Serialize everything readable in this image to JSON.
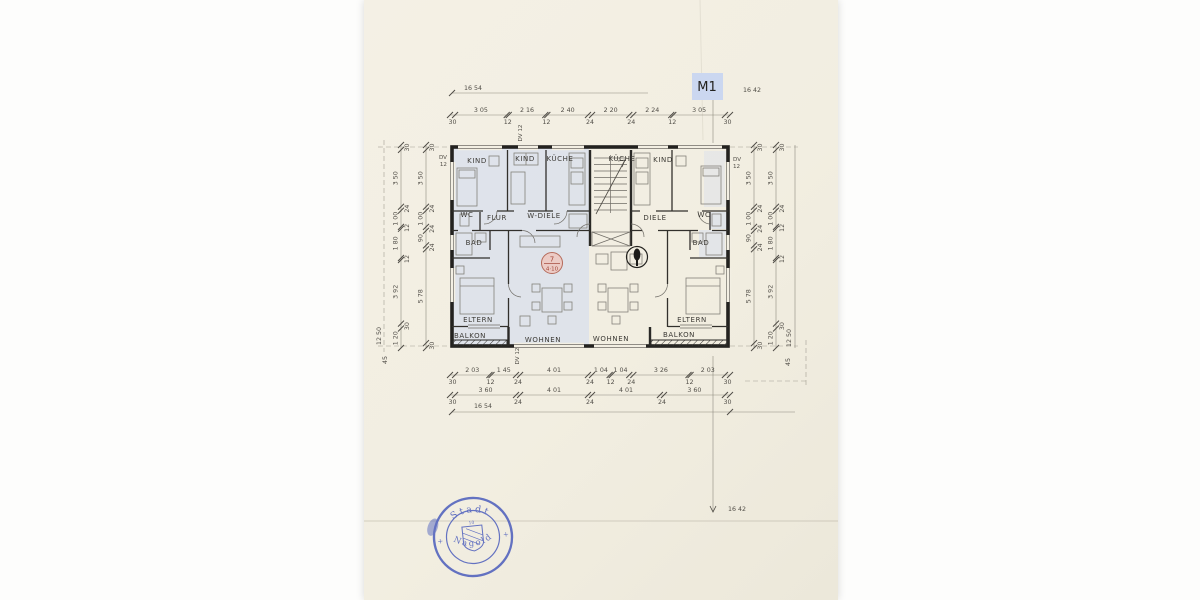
{
  "plan_label": "M1",
  "colors": {
    "paper": "#f3efe3",
    "highlight_blue": "#cdd8f2",
    "m1_box_bg": "#cbd7f0",
    "stamp_blue": "#4457bb",
    "marker_orange": "#edb3a6",
    "ink": "#2a2926"
  },
  "rooms": {
    "left": {
      "kind1": "KIND",
      "kind2": "KIND",
      "kueche": "KÜCHE",
      "wc": "WC",
      "flur": "FLUR",
      "wdiele": "W-DIELE",
      "bad": "BAD",
      "eltern": "ELTERN",
      "balkon": "BALKON",
      "wohnen": "WOHNEN"
    },
    "right": {
      "kueche": "KÜCHE",
      "kind": "KIND",
      "diele": "DIELE",
      "wc": "WC",
      "bad": "BAD",
      "eltern": "ELTERN",
      "balkon": "BALKON",
      "wohnen": "WOHNEN"
    }
  },
  "markers": {
    "left_unit_number": "7",
    "left_unit_sub": "4·10"
  },
  "annotations": {
    "dv_left_1": "DV",
    "dv_left_2": "12",
    "dv_right_1": "DV",
    "dv_right_2": "12",
    "dv_top_center": "DV 12",
    "dv_bottom_center": "DV 12"
  },
  "dimensions": {
    "top_overall_left": "16 54",
    "top_overall_right": "16 42",
    "top_row": [
      "30",
      "3 05",
      "12",
      "2 16",
      "12",
      "2 40",
      "24",
      "2 20",
      "24",
      "2 24",
      "12",
      "3 05",
      "30"
    ],
    "bottom_row1": [
      "30",
      "2 03",
      "12",
      "1 45",
      "24",
      "4 01",
      "24",
      "1 04",
      "12",
      "1 04",
      "24",
      "3 26",
      "12",
      "2 03",
      "30"
    ],
    "bottom_row2": [
      "30",
      "3 60",
      "24",
      "4 01",
      "24",
      "4 01",
      "24",
      "3 60",
      "30"
    ],
    "bottom_overall": "16 54",
    "bottom_overall_right": "16 42",
    "side_outer": [
      "30",
      "3 50",
      "24",
      "1 00",
      "12",
      "1 80",
      "12",
      "3 92",
      "30",
      "1 20"
    ],
    "side_inner": [
      "30",
      "3 50",
      "24",
      "1 00",
      "24",
      "90",
      "24",
      "5 78",
      "30"
    ],
    "side_overall": "12 50",
    "side_edge": "45"
  },
  "stamp": {
    "top_text": "Stadt",
    "bottom_text": "Nagold",
    "center_number": "10",
    "left_mark": "+",
    "right_mark": "+"
  }
}
